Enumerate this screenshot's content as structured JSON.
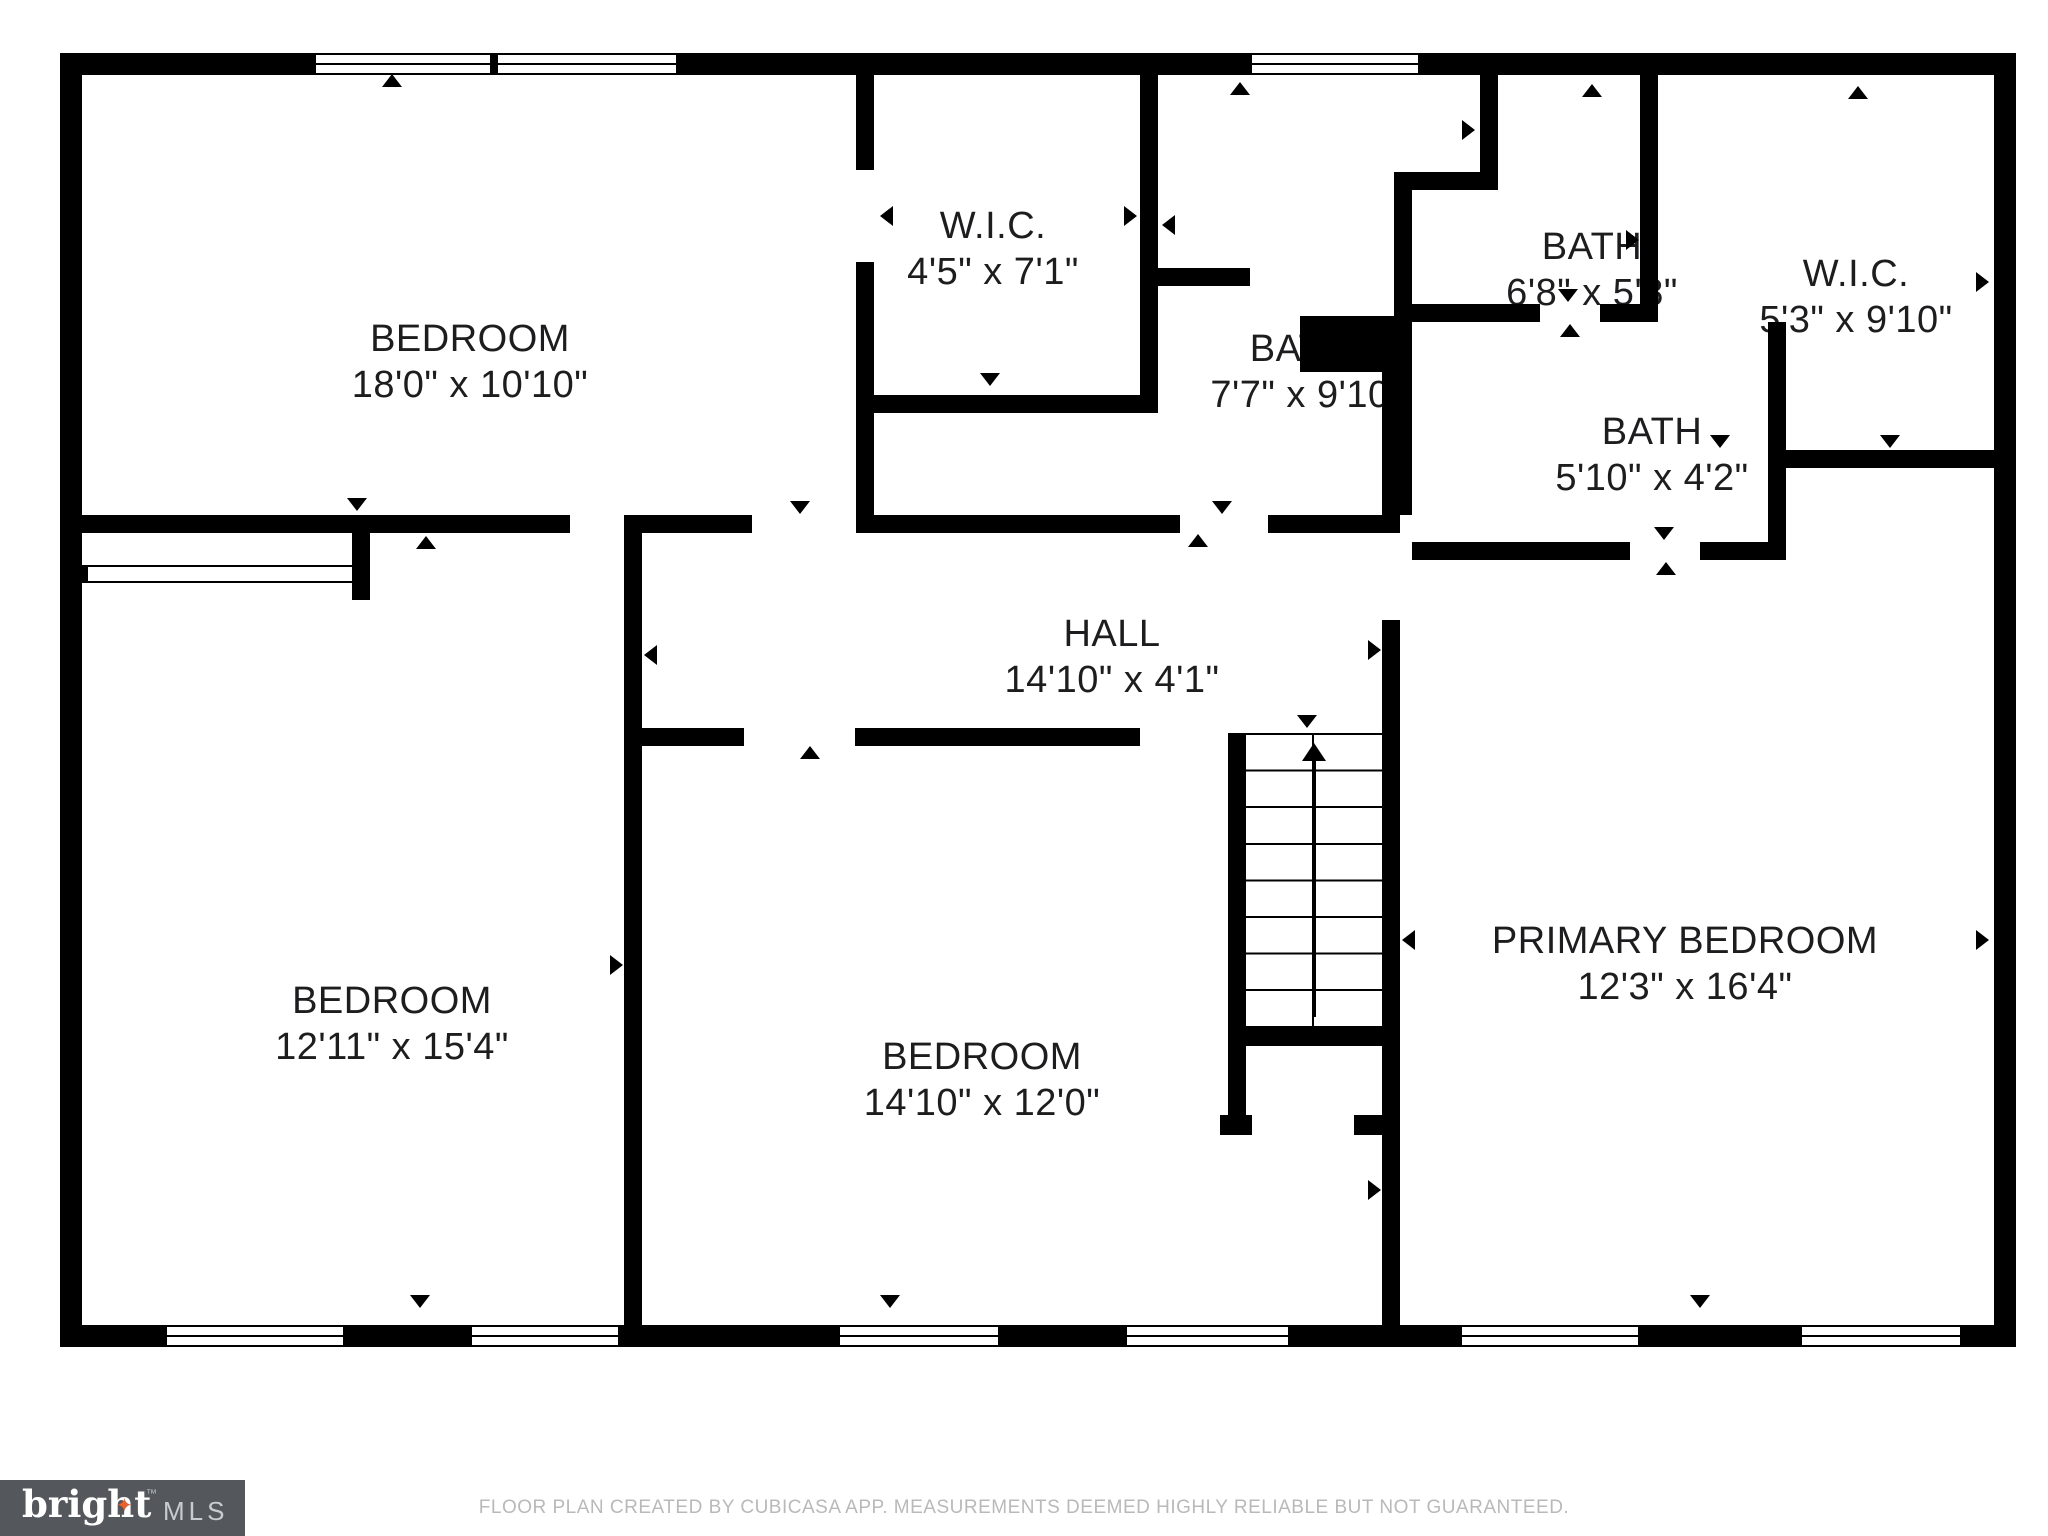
{
  "rooms": [
    {
      "name": "BEDROOM",
      "dims": "18'0\" x 10'10\""
    },
    {
      "name": "W.I.C.",
      "dims": "4'5\" x 7'1\""
    },
    {
      "name": "BATH",
      "dims": "7'7\" x 9'10"
    },
    {
      "name": "BATH",
      "dims": "6'8\" x 5'8\""
    },
    {
      "name": "W.I.C.",
      "dims": "5'3\" x 9'10\""
    },
    {
      "name": "BATH",
      "dims": "5'10\" x 4'2\""
    },
    {
      "name": "HALL",
      "dims": "14'10\" x 4'1\""
    },
    {
      "name": "BEDROOM",
      "dims": "12'11\" x 15'4\""
    },
    {
      "name": "BEDROOM",
      "dims": "14'10\" x 12'0\""
    },
    {
      "name": "PRIMARY BEDROOM",
      "dims": "12'3\" x 16'4\""
    }
  ],
  "footer": {
    "disclaimer": "FLOOR PLAN CREATED BY CUBICASA APP. MEASUREMENTS DEEMED HIGHLY RELIABLE BUT NOT GUARANTEED."
  },
  "logo": {
    "brand": "bright",
    "tm": "™",
    "suffix": "MLS",
    "star": "✦"
  },
  "colors": {
    "wall": "#000000",
    "background": "#ffffff",
    "footer_text": "#b9b9b9",
    "logo_bg": "#54585c",
    "logo_star": "#e8622d",
    "label_text": "#1d1d1f"
  }
}
